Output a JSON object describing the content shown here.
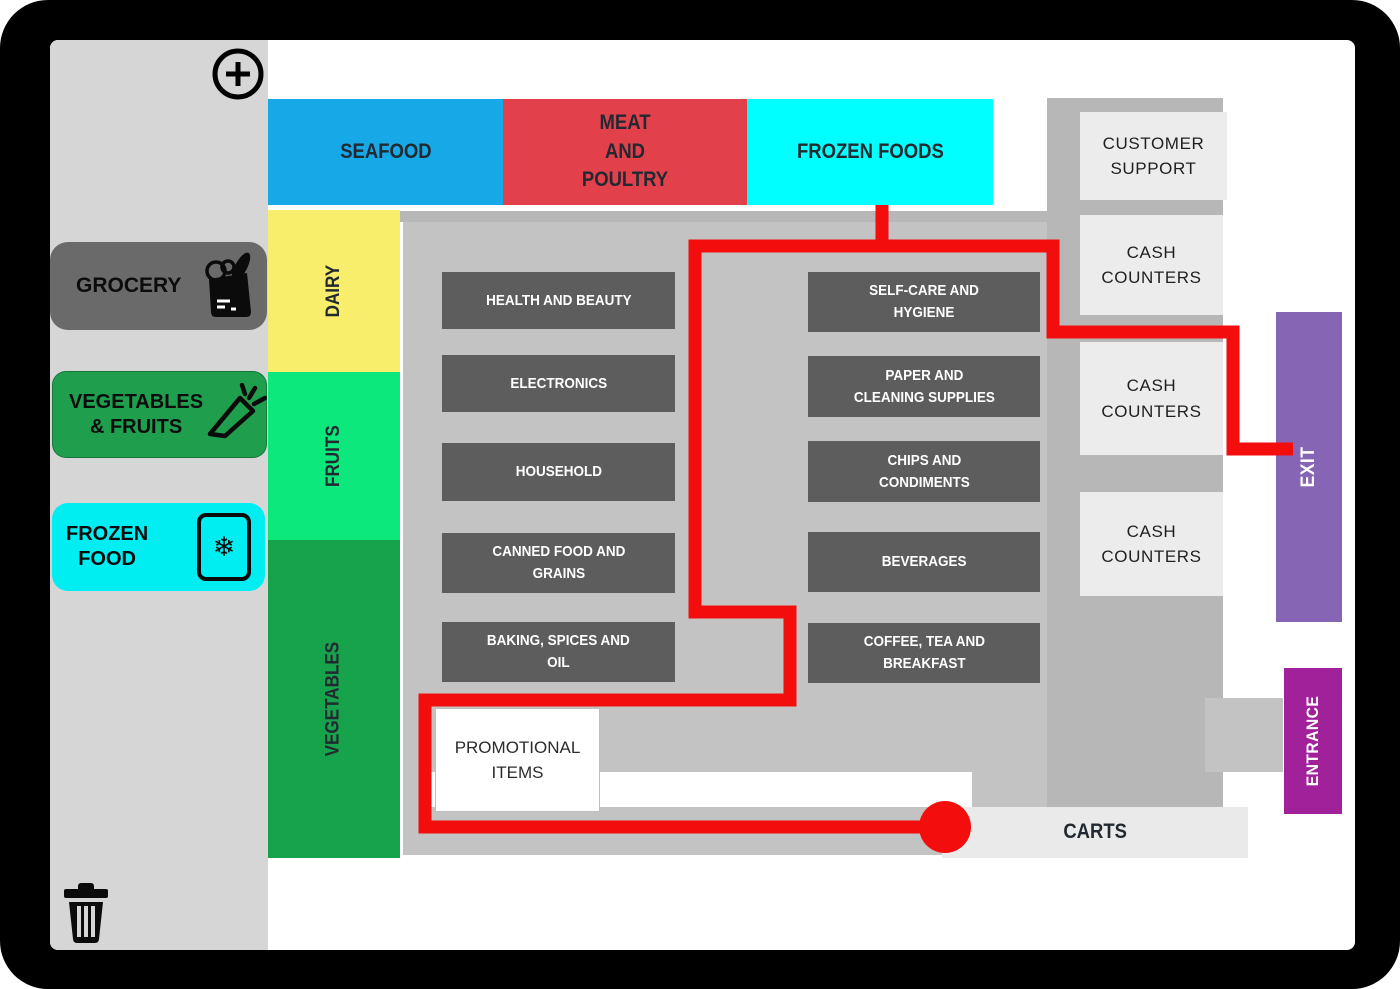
{
  "app": {
    "kind": "supermarket-map-editor"
  },
  "toolbar": {
    "add_icon": "plus-circle",
    "delete_icon": "trash"
  },
  "sidebar": {
    "buttons": [
      {
        "label": "GROCERY",
        "icon": "grocery-bag",
        "color": "#6a6a6a"
      },
      {
        "label": "VEGETABLES\n& FRUITS",
        "icon": "carrot",
        "color": "#1f9e4d"
      },
      {
        "label": "FROZEN\nFOOD",
        "icon": "frozen-package",
        "color": "#00eef2"
      }
    ],
    "snowflake_glyph": "❄"
  },
  "map": {
    "top_sections": [
      {
        "label": "SEAFOOD",
        "color": "#17a8e8"
      },
      {
        "label": "MEAT\nAND\nPOULTRY",
        "color": "#e2414b"
      },
      {
        "label": "FROZEN FOODS",
        "color": "#00ffff"
      }
    ],
    "left_sections": [
      {
        "label": "DAIRY",
        "color": "#f9ee6b"
      },
      {
        "label": "FRUITS",
        "color": "#0ce87c"
      },
      {
        "label": "VEGETABLES",
        "color": "#17a34c"
      }
    ],
    "aisles_left": [
      "HEALTH AND BEAUTY",
      "ELECTRONICS",
      "HOUSEHOLD",
      "CANNED FOOD AND\nGRAINS",
      "BAKING, SPICES AND\nOIL"
    ],
    "aisles_right": [
      "SELF-CARE AND\nHYGIENE",
      "PAPER AND\nCLEANING SUPPLIES",
      "CHIPS AND\nCONDIMENTS",
      "BEVERAGES",
      "COFFEE, TEA AND\nBREAKFAST"
    ],
    "services": [
      "CUSTOMER\nSUPPORT",
      "CASH\nCOUNTERS",
      "CASH\nCOUNTERS",
      "CASH\nCOUNTERS"
    ],
    "promo_label": "PROMOTIONAL\nITEMS",
    "carts_label": "CARTS",
    "exit_label": "EXIT",
    "entrance_label": "ENTRANCE",
    "exit_color": "#8765b5",
    "entrance_color": "#a1219b",
    "route": {
      "color": "#f30d0d",
      "marker": "current-location-dot"
    }
  }
}
